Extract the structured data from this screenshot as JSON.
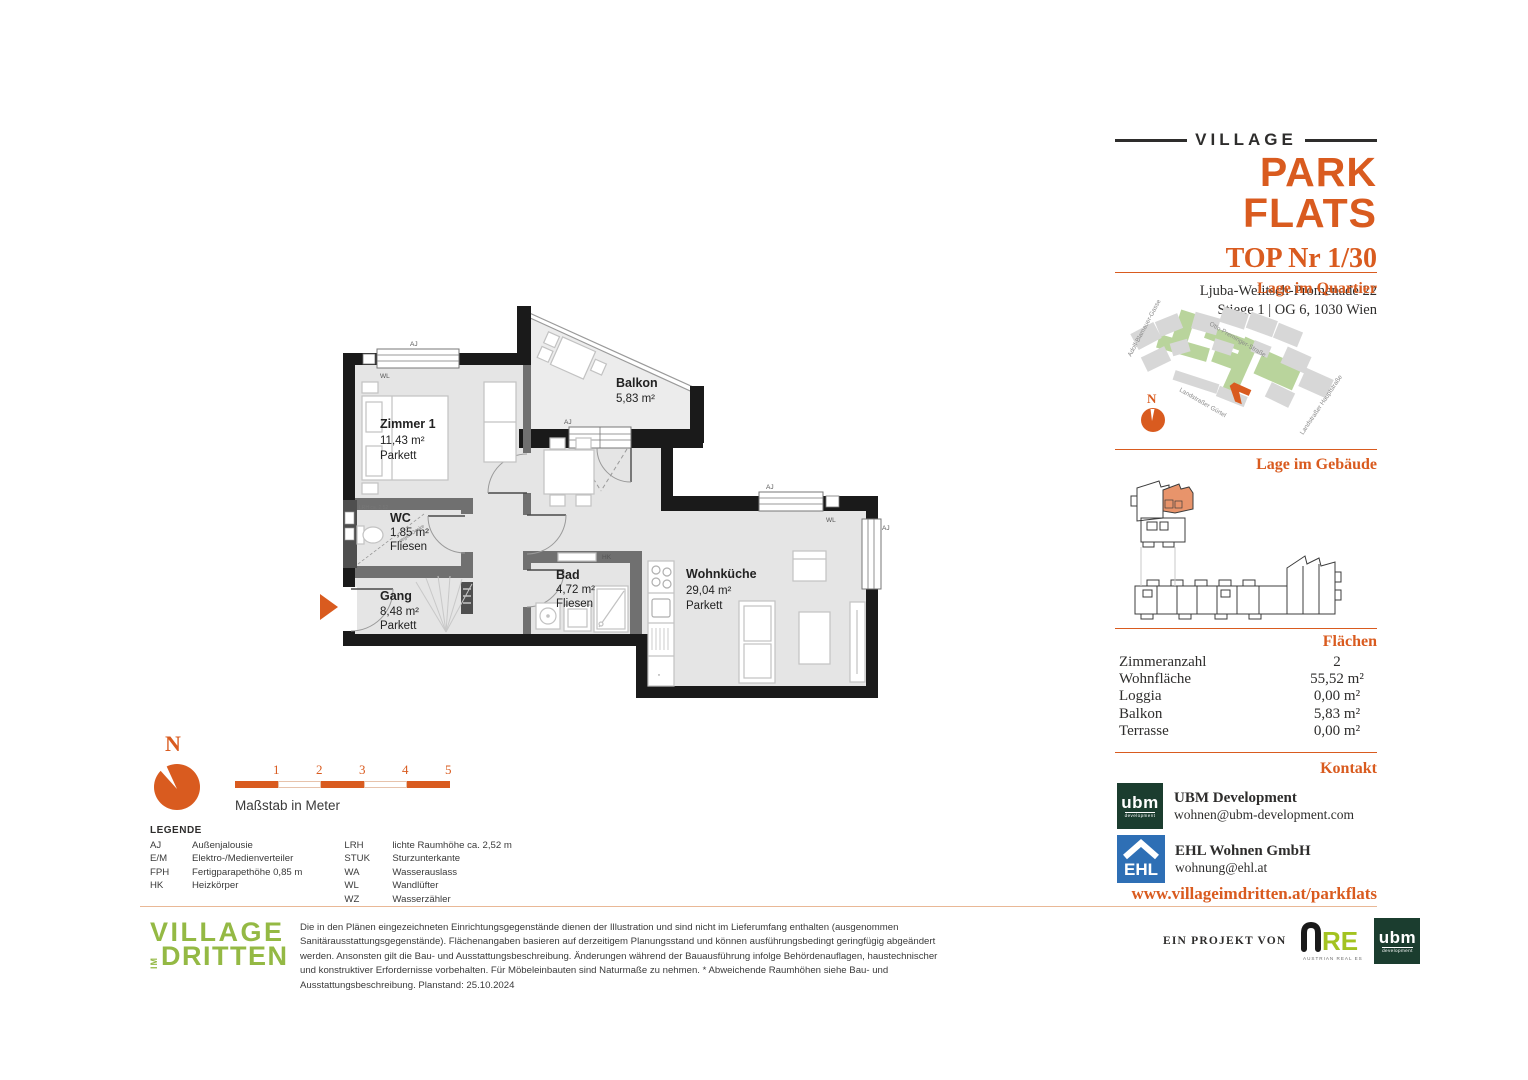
{
  "header": {
    "brand_top": "VILLAGE",
    "brand_main": "PARK FLATS",
    "unit_title": "TOP Nr 1/30",
    "address_line1": "Ljuba-Welitsch-Promenade 22",
    "address_line2": "Stiege 1 | OG 6, 1030 Wien"
  },
  "sections": {
    "quartier": "Lage im Quartier",
    "gebaeude": "Lage im Gebäude",
    "flaechen": "Flächen",
    "kontakt": "Kontakt"
  },
  "map": {
    "compass_n": "N",
    "streets": [
      "Adolf-Blamauer-Gasse",
      "Otto-Preminger-Straße",
      "Landstraßer Gürtel",
      "Landstraßer Hauptstraße"
    ]
  },
  "areas": {
    "rows": [
      {
        "label": "Zimmeranzahl",
        "value": "2"
      },
      {
        "label": "Wohnfläche",
        "value": "55,52 m²"
      },
      {
        "label": "Loggia",
        "value": "0,00 m²"
      },
      {
        "label": "Balkon",
        "value": "5,83 m²"
      },
      {
        "label": "Terrasse",
        "value": "0,00 m²"
      }
    ]
  },
  "contact": {
    "companies": [
      {
        "name": "UBM Development",
        "email": "wohnen@ubm-development.com"
      },
      {
        "name": "EHL Wohnen GmbH",
        "email": "wohnung@ehl.at"
      }
    ],
    "website": "www.villageimdritten.at/parkflats"
  },
  "plan": {
    "rooms": [
      {
        "name": "Zimmer 1",
        "area": "11,43 m²",
        "floor": "Parkett"
      },
      {
        "name": "Balkon",
        "area": "5,83 m²",
        "floor": ""
      },
      {
        "name": "WC",
        "area": "1,85 m²",
        "floor": "Fliesen"
      },
      {
        "name": "Gang",
        "area": "8,48 m²",
        "floor": "Parkett"
      },
      {
        "name": "Bad",
        "area": "4,72 m²",
        "floor": "Fliesen"
      },
      {
        "name": "Wohnküche",
        "area": "29,04 m²",
        "floor": "Parkett"
      }
    ],
    "tags": {
      "aj": "AJ",
      "wl": "WL",
      "hk": "HK",
      "lrh": "LRH ca. 2,52",
      "slope": "gegen Decke"
    }
  },
  "compass_n": "N",
  "scalebar": {
    "ticks": [
      "1",
      "2",
      "3",
      "4",
      "5"
    ],
    "caption": "Maßstab in Meter"
  },
  "legend": {
    "title": "LEGENDE",
    "col1": [
      {
        "abbr": "AJ",
        "term": "Außenjalousie"
      },
      {
        "abbr": "E/M",
        "term": "Elektro-/Medienverteiler"
      },
      {
        "abbr": "FPH",
        "term": "Fertigparapethöhe 0,85 m"
      },
      {
        "abbr": "HK",
        "term": "Heizkörper"
      }
    ],
    "col2": [
      {
        "abbr": "LRH",
        "term": "lichte Raumhöhe ca. 2,52 m"
      },
      {
        "abbr": "STUK",
        "term": "Sturzunterkante"
      },
      {
        "abbr": "WA",
        "term": "Wasserauslass"
      },
      {
        "abbr": "WL",
        "term": "Wandlüfter"
      },
      {
        "abbr": "WZ",
        "term": "Wasserzähler"
      }
    ]
  },
  "footer": {
    "disclaimer": "Die in den Plänen eingezeichneten Einrichtungsgegenstände dienen der Illustration und sind nicht im Lieferumfang enthalten (ausgenommen Sanitärausstattungsgegenstände). Flächenangaben basieren auf derzeitigem Planungsstand und können ausführungsbedingt geringfügig abgeändert werden. Ansonsten gilt die Bau- und Ausstattungsbeschreibung. Änderungen während der Bauausführung infolge Behördenauflagen, haustechnischer und konstruktiver Erfordernisse vorbehalten. Für Möbeleinbauten sind Naturmaße zu nehmen. * Abweichende Raumhöhen siehe Bau- und Ausstattungsbeschreibung. Planstand: 25.10.2024",
    "village_line1": "VILLAGE",
    "village_im": "IM",
    "village_line2": "DRITTEN",
    "projekt_prefix": "EIN PROJEKT VON",
    "are_text": "RE",
    "are_sub": "AUSTRIAN REAL ESTATE",
    "ubm_text": "ubm",
    "ubm_sub": "development",
    "ehl_text": "EHL"
  },
  "colors": {
    "accent_orange": "#D95B1F",
    "logo_green": "#94B944",
    "map_green": "#B9D49C",
    "ubm_green": "#1B3D2F",
    "ehl_blue": "#2E6FB5",
    "are_green": "#A3C320"
  }
}
